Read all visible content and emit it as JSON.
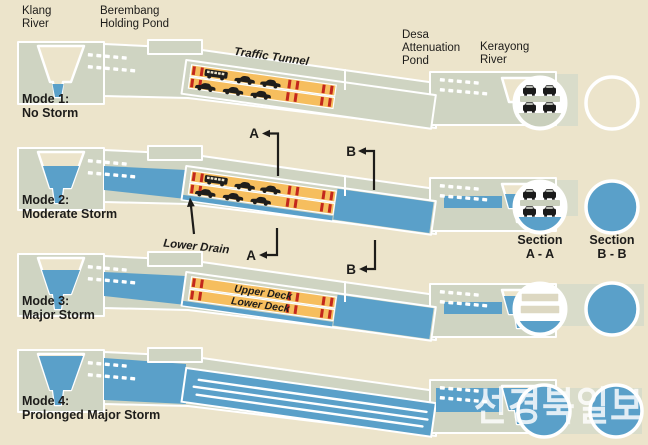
{
  "labels": {
    "klang": [
      "Klang",
      "River"
    ],
    "berembang": [
      "Berembang",
      "Holding Pond"
    ],
    "traffic_tunnel": "Traffic Tunnel",
    "desa": [
      "Desa",
      "Attenuation",
      "Pond"
    ],
    "kerayong": [
      "Kerayong",
      "River"
    ],
    "lower_drain": "Lower Drain",
    "upper_deck": "Upper Deck",
    "lower_deck": "Lower Deck",
    "section_a": [
      "Section",
      "A - A"
    ],
    "section_b": [
      "Section",
      "B - B"
    ],
    "marker_a": "A",
    "marker_b": "B"
  },
  "modes": [
    {
      "label": "Mode 1:",
      "condition": "No Storm",
      "tunnel_state": "traffic on both decks, no water diversion",
      "klang_water": "low",
      "kerayong_water": "low",
      "section_a_state": "cars on two decks, dry",
      "section_b_state": "empty"
    },
    {
      "label": "Mode 2:",
      "condition": "Moderate Storm",
      "tunnel_state": "traffic on both decks, stormwater in lower drain",
      "klang_water": "moderate",
      "kerayong_water": "moderate",
      "section_a_state": "cars on two decks, water in lower drain",
      "section_b_state": "flooded"
    },
    {
      "label": "Mode 3:",
      "condition": "Major Storm",
      "tunnel_state": "decks closed to traffic, stormwater in lower drain",
      "klang_water": "high",
      "kerayong_water": "high",
      "section_a_state": "decks empty, water in lower drain",
      "section_b_state": "flooded"
    },
    {
      "label": "Mode 4:",
      "condition": "Prolonged Major Storm",
      "tunnel_state": "entire tunnel flooded",
      "klang_water": "full",
      "kerayong_water": "full",
      "section_a_state": "flooded",
      "section_b_state": "flooded"
    }
  ],
  "watermark": {
    "text": "선경북일보"
  },
  "colors": {
    "background": "#ece4cb",
    "ground": "#cfd4c2",
    "water": "#5aa0c9",
    "deck_orange": "#f6be5e",
    "marker_red": "#c3271c",
    "text": "#1d1c1a",
    "outline": "#ffffff"
  }
}
